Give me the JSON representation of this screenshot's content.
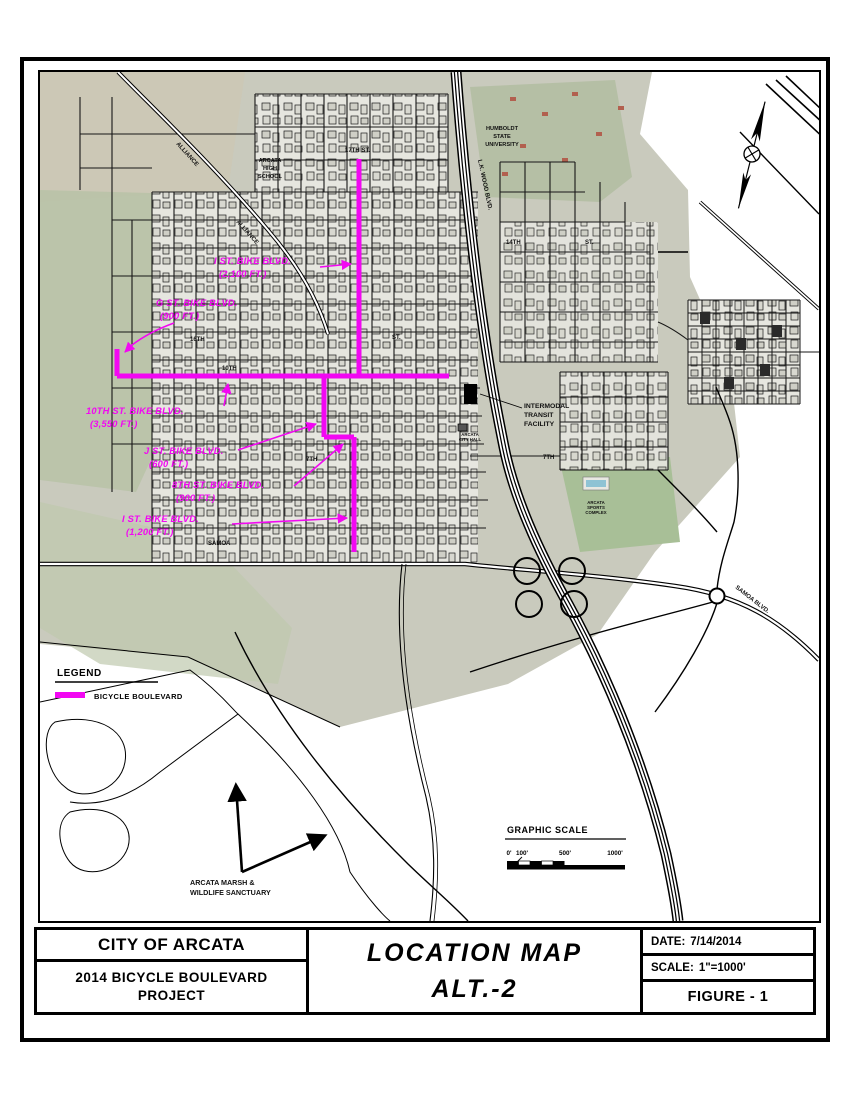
{
  "title_block": {
    "agency": "CITY OF ARCATA",
    "project_line1": "2014  BICYCLE  BOULEVARD",
    "project_line2": "PROJECT",
    "title_line1": "LOCATION  MAP",
    "title_line2": "ALT.-2",
    "date_label": "DATE:",
    "date_value": "7/14/2014",
    "scale_label": "SCALE:",
    "scale_value": "1\"=1000'",
    "figure": "FIGURE - 1"
  },
  "legend": {
    "title": "LEGEND",
    "item": "BICYCLE  BOULEVARD",
    "swatch_color": "#f207f2"
  },
  "scale_bar": {
    "title": "GRAPHIC  SCALE",
    "ticks": [
      "0'",
      "100'",
      "500'",
      "1000'"
    ]
  },
  "routes": {
    "i_st_north": {
      "name": "I ST. BIKE BLVD.",
      "length": "(2,100 FT.)"
    },
    "g_st": {
      "name": "G ST. BIKE BLVD.",
      "length": "(900 FT.)"
    },
    "tenth_st": {
      "name": "10TH ST. BIKE BLVD.",
      "length": "(3,550 FT.)"
    },
    "j_st": {
      "name": "J ST. BIKE BLVD.",
      "length": "(600 FT.)"
    },
    "eighth_st": {
      "name": "8TH ST. BIKE BLVD.",
      "length": "(900 FT.)"
    },
    "i_st_south": {
      "name": "I ST. BIKE BLVD.",
      "length": "(1,200 FT.)"
    }
  },
  "streets": {
    "s17": "17TH ST.",
    "s16": "16TH",
    "st_e": "ST.",
    "s10": "10TH",
    "s14": "14TH",
    "s14_st": "ST.",
    "s7_w": "7TH",
    "s7_e": "7TH",
    "samoa": "SAMOA",
    "samoa_blvd": "SAMOA   BLVD.",
    "alliance1": "ALLIANCE",
    "alliance2": "ALLIANCE",
    "lk_wood": "L.K. WOOD  BLVD."
  },
  "poi": {
    "high_school": [
      "ARCATA",
      "HIGH",
      "SCHOOL"
    ],
    "hsu": [
      "HUMBOLDT",
      "STATE",
      "UNIVERSITY"
    ],
    "transit": [
      "INTERMODAL",
      "TRANSIT",
      "FACILITY"
    ],
    "city_hall": [
      "ARCATA",
      "CITY HALL"
    ],
    "sports": [
      "ARCATA",
      "SPORTS",
      "COMPLEX"
    ],
    "marsh": [
      "ARCATA MARSH &",
      "WILDLIFE SANCTUARY"
    ]
  },
  "colors": {
    "bicycle_boulevard": "#f207f2",
    "ink": "#000000",
    "aerial_tint": "#c9cabd"
  }
}
